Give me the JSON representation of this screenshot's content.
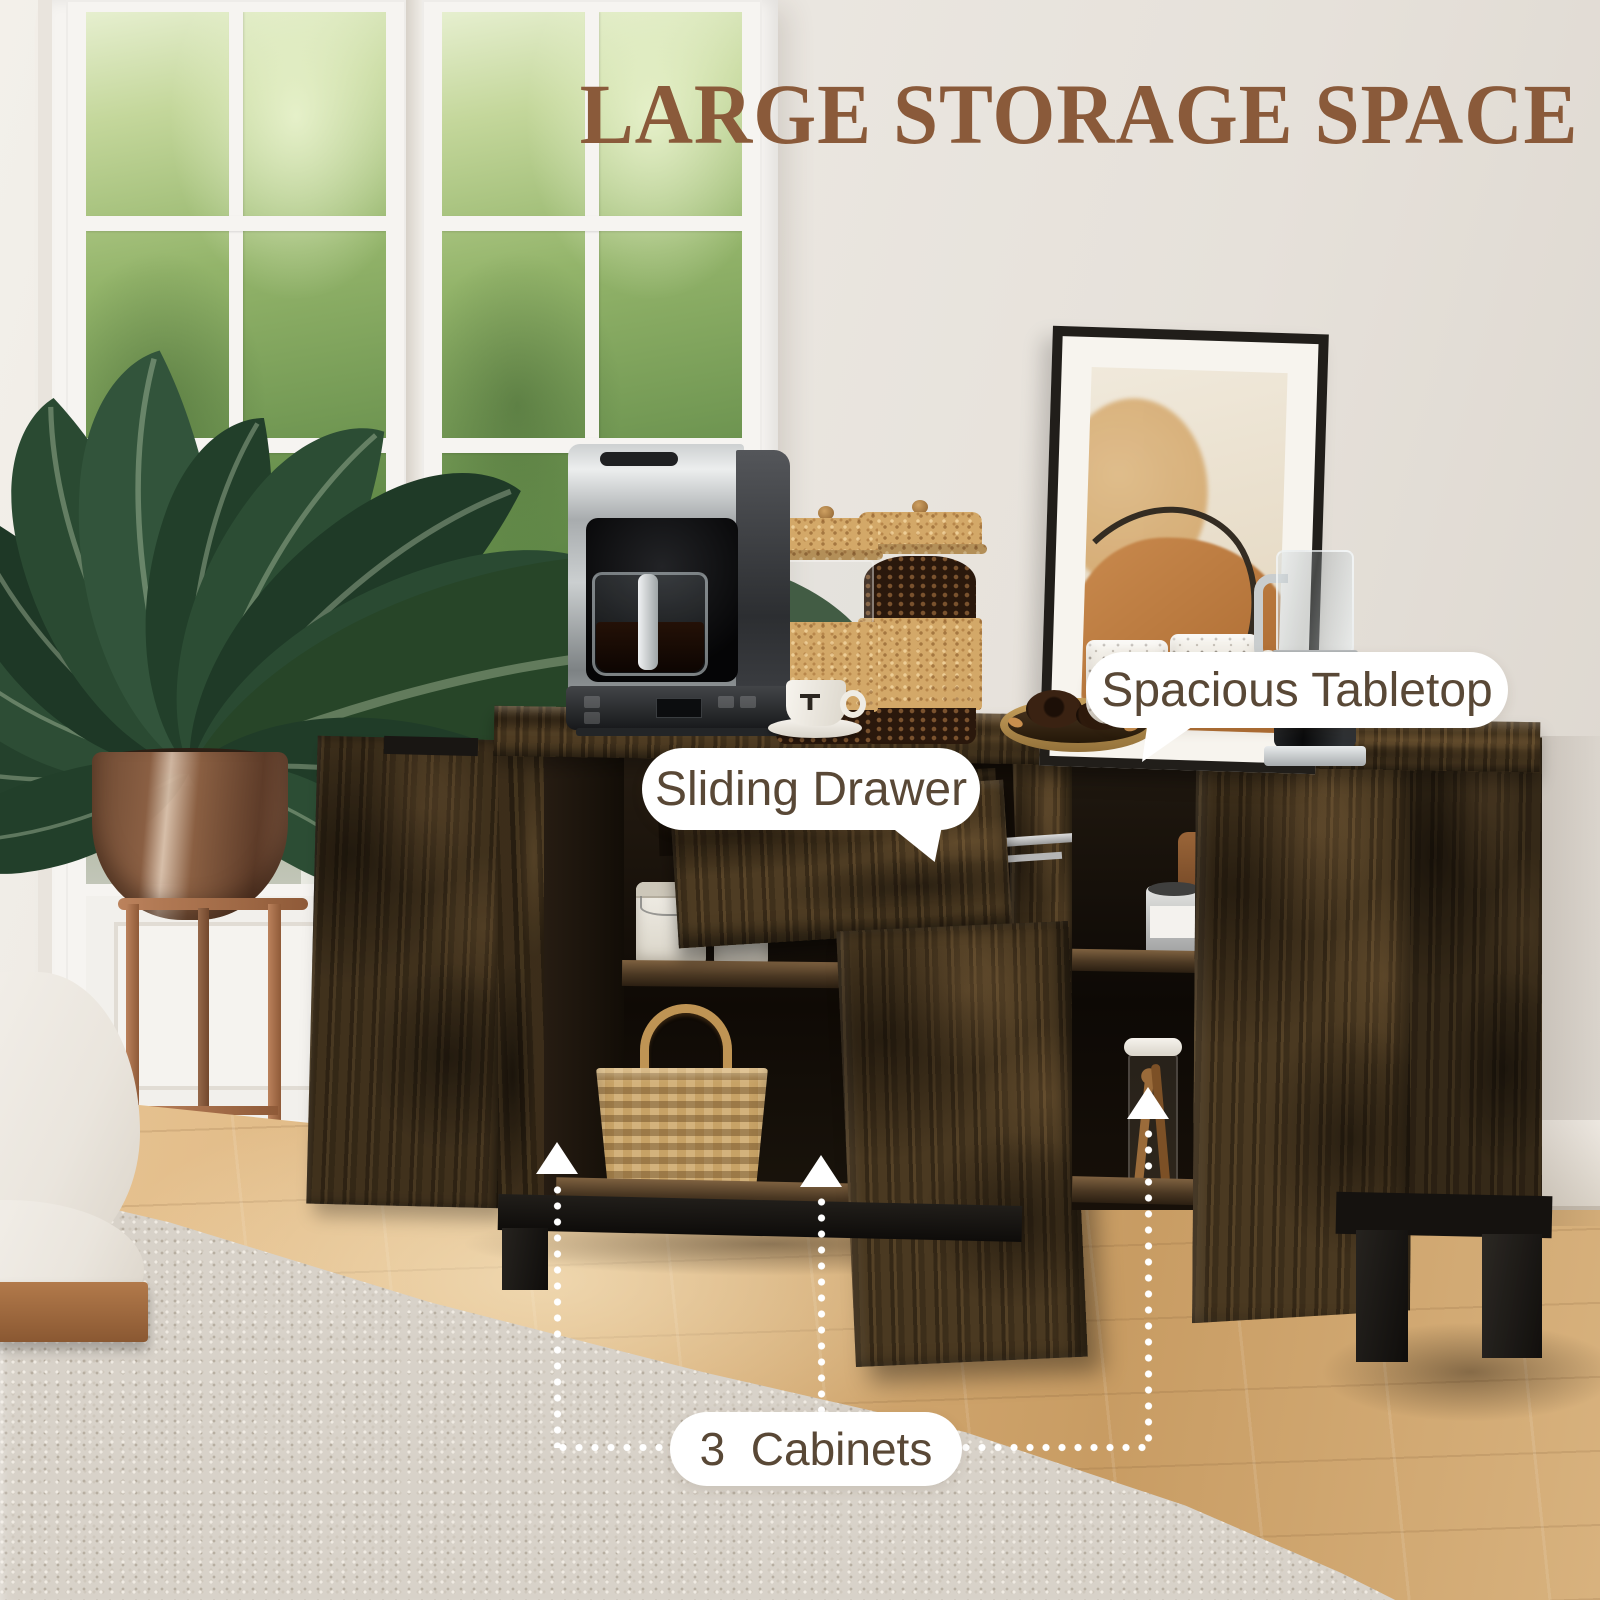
{
  "meta": {
    "description": "Product lifestyle photo of a rustic wood sideboard storage cabinet with annotated features"
  },
  "title": {
    "text": "LARGE STORAGE SPACE"
  },
  "callouts": {
    "tabletop": {
      "label": "Spacious Tabletop"
    },
    "drawer": {
      "label": "Sliding Drawer"
    },
    "cabinets": {
      "label": "3  Cabinets"
    }
  },
  "annotation_arrows": {
    "icon": "up-arrow-icon",
    "count": 3,
    "style": "white triangle with dotted connector line"
  },
  "colors": {
    "title_text": "#8a5a3a",
    "callout_text": "#594836",
    "callout_bubble": "#ffffff",
    "connector_dots": "#ffffff",
    "cabinet_wood": "#46361f",
    "floor_wood": "#d8b27e",
    "rug": "#d8d2c9",
    "wall": "#e9e4de",
    "plant_green": "#2a4a32"
  }
}
